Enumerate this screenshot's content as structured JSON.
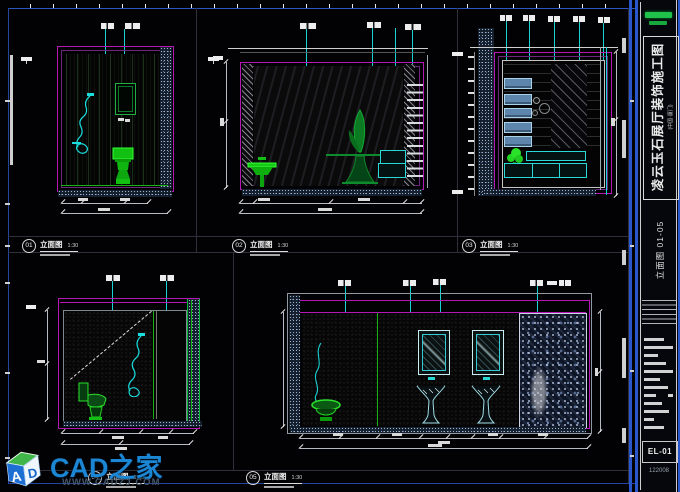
{
  "colors": {
    "accent_magenta": "#b517b5",
    "accent_cyan": "#17d3d3",
    "fixture_green": "#16c816",
    "sheet_border_blue": "#2b57cc",
    "watermark_blue": "#1b86d4",
    "logo_green": "#1fc24a"
  },
  "panels": [
    {
      "num": "01",
      "name": "立面图",
      "scale": "1:30"
    },
    {
      "num": "02",
      "name": "立面图",
      "scale": "1:30"
    },
    {
      "num": "03",
      "name": "立面图",
      "scale": "1:30"
    },
    {
      "num": "04",
      "name": "立面图",
      "scale": "1:30"
    },
    {
      "num": "05",
      "name": "立面图",
      "scale": "1:30"
    }
  ],
  "title_block": {
    "project_title": "凌云玉石展厅装饰施工图",
    "project_subtitle": "(中国·厦门)",
    "sheet_name": "立面图 01-05",
    "sheet_number": "EL-01",
    "date_code": "122008"
  },
  "watermark": {
    "site_name": "CAD之家",
    "site_url": "WWW.CADZJ.COM",
    "logo_letter_a": "A",
    "logo_letter_d": "D"
  }
}
